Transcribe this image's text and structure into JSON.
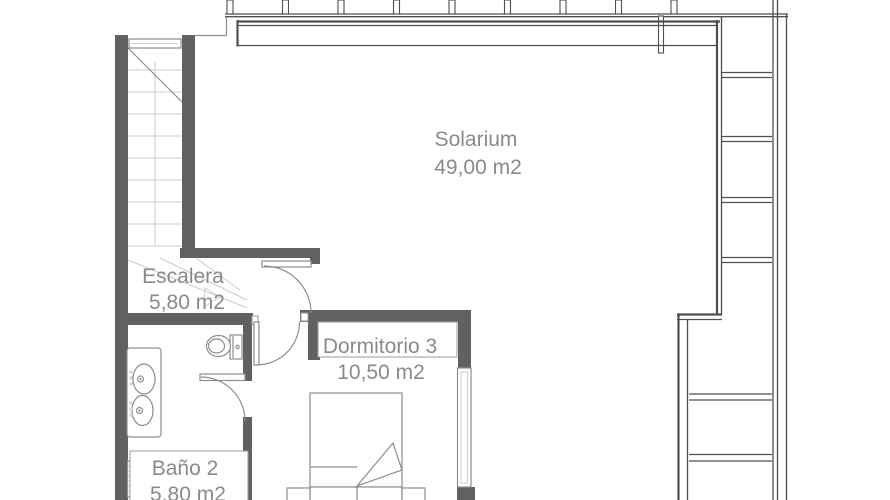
{
  "plan": {
    "rooms": [
      {
        "name": "Solarium",
        "area": "49,00 m2"
      },
      {
        "name": "Escalera",
        "area": "5,80 m2"
      },
      {
        "name": "Dormitorio 3",
        "area": "10,50 m2"
      },
      {
        "name": "Baño 2",
        "area": "5,80 m2"
      }
    ],
    "symbols": [
      "stairs-symbol",
      "door-arc-symbol",
      "toilet-symbol",
      "double-sink-vanity-symbol",
      "bed-symbol",
      "nightstand-symbol",
      "window-symbol",
      "pergola-beams-symbol",
      "radiator-symbol"
    ]
  },
  "colors": {
    "bg": "#ffffff",
    "wall_fill": "#616161",
    "line_dark": "#4f4f4f",
    "line_med": "#8d8d8d",
    "line_light": "#cccccc",
    "text_color": "#8a8a8a"
  }
}
